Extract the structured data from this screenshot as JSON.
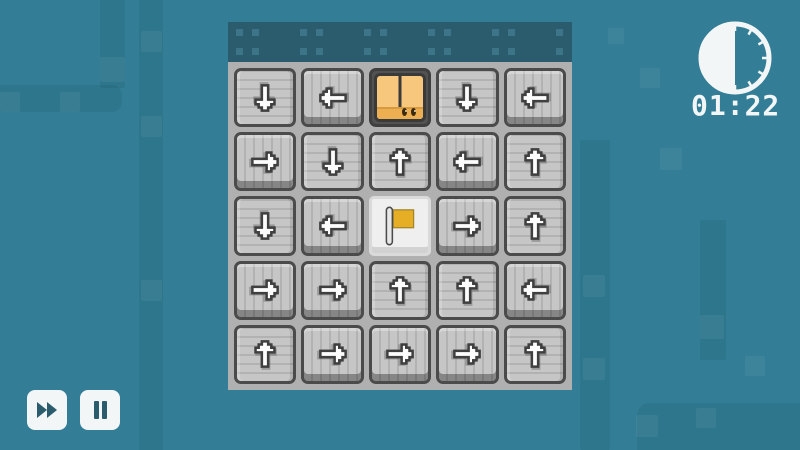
{
  "hud": {
    "timer": {
      "time": "01:22",
      "icon": "clock-half-icon",
      "clock_fill_fraction": 0.5
    },
    "controls": [
      {
        "id": "fast-forward",
        "icon": "fast-forward-icon",
        "label": "Fast forward"
      },
      {
        "id": "pause",
        "icon": "pause-icon",
        "label": "Pause"
      }
    ]
  },
  "board": {
    "rows": 5,
    "cols": 5,
    "cells": [
      [
        "down",
        "left",
        "player",
        "down",
        "left"
      ],
      [
        "right",
        "down",
        "up",
        "left",
        "up"
      ],
      [
        "down",
        "left",
        "flag",
        "right",
        "up"
      ],
      [
        "right",
        "right",
        "up",
        "up",
        "left"
      ],
      [
        "up",
        "right",
        "right",
        "right",
        "up"
      ]
    ]
  },
  "colors": {
    "background": "#337E96",
    "board_header": "#2B5C6E",
    "board_gap": "#B0B0B0",
    "tile": "#C6C6C6",
    "tile_border": "#4B4B4B",
    "arrow_fill": "#FCFCFC",
    "player_box": "#F7C77D",
    "player_box_bottom": "#ECB052",
    "flag_yellow": "#E6AE24",
    "hud_white": "#F2F6F6",
    "hud_icon_teal": "#2B5C6E"
  }
}
